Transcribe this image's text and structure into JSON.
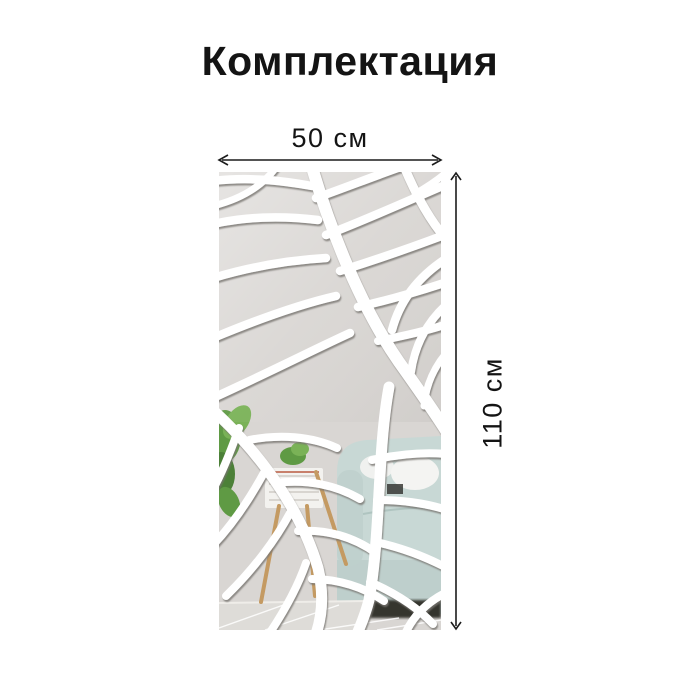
{
  "page": {
    "title": "Комплектация"
  },
  "dimensions": {
    "width_label": "50 см",
    "height_label": "110 см"
  },
  "panel": {
    "icon": "leaf-vein-mirror-panel",
    "reflection_icons": [
      "plant-icon",
      "table-icon",
      "sofa-icon",
      "floor-tiles-icon"
    ]
  },
  "colors": {
    "background": "#ffffff",
    "text": "#141414",
    "arrow": "#1c1c1c",
    "mirror_piece": "#d9d6d3",
    "vein": "#ffffff",
    "vein_shadow": "#77756f",
    "sofa_reflection": "#c8d8d5",
    "sofa_front": "#becfcc",
    "pillow": "#f4f4f2",
    "plant": "#5f9a44",
    "plant_light": "#7ab257",
    "plant_dark": "#4c8038",
    "wood": "#c49a62",
    "table": "#f3f2ef",
    "floor": "#dedcd8",
    "under_sofa_shadow": "#35342f"
  }
}
